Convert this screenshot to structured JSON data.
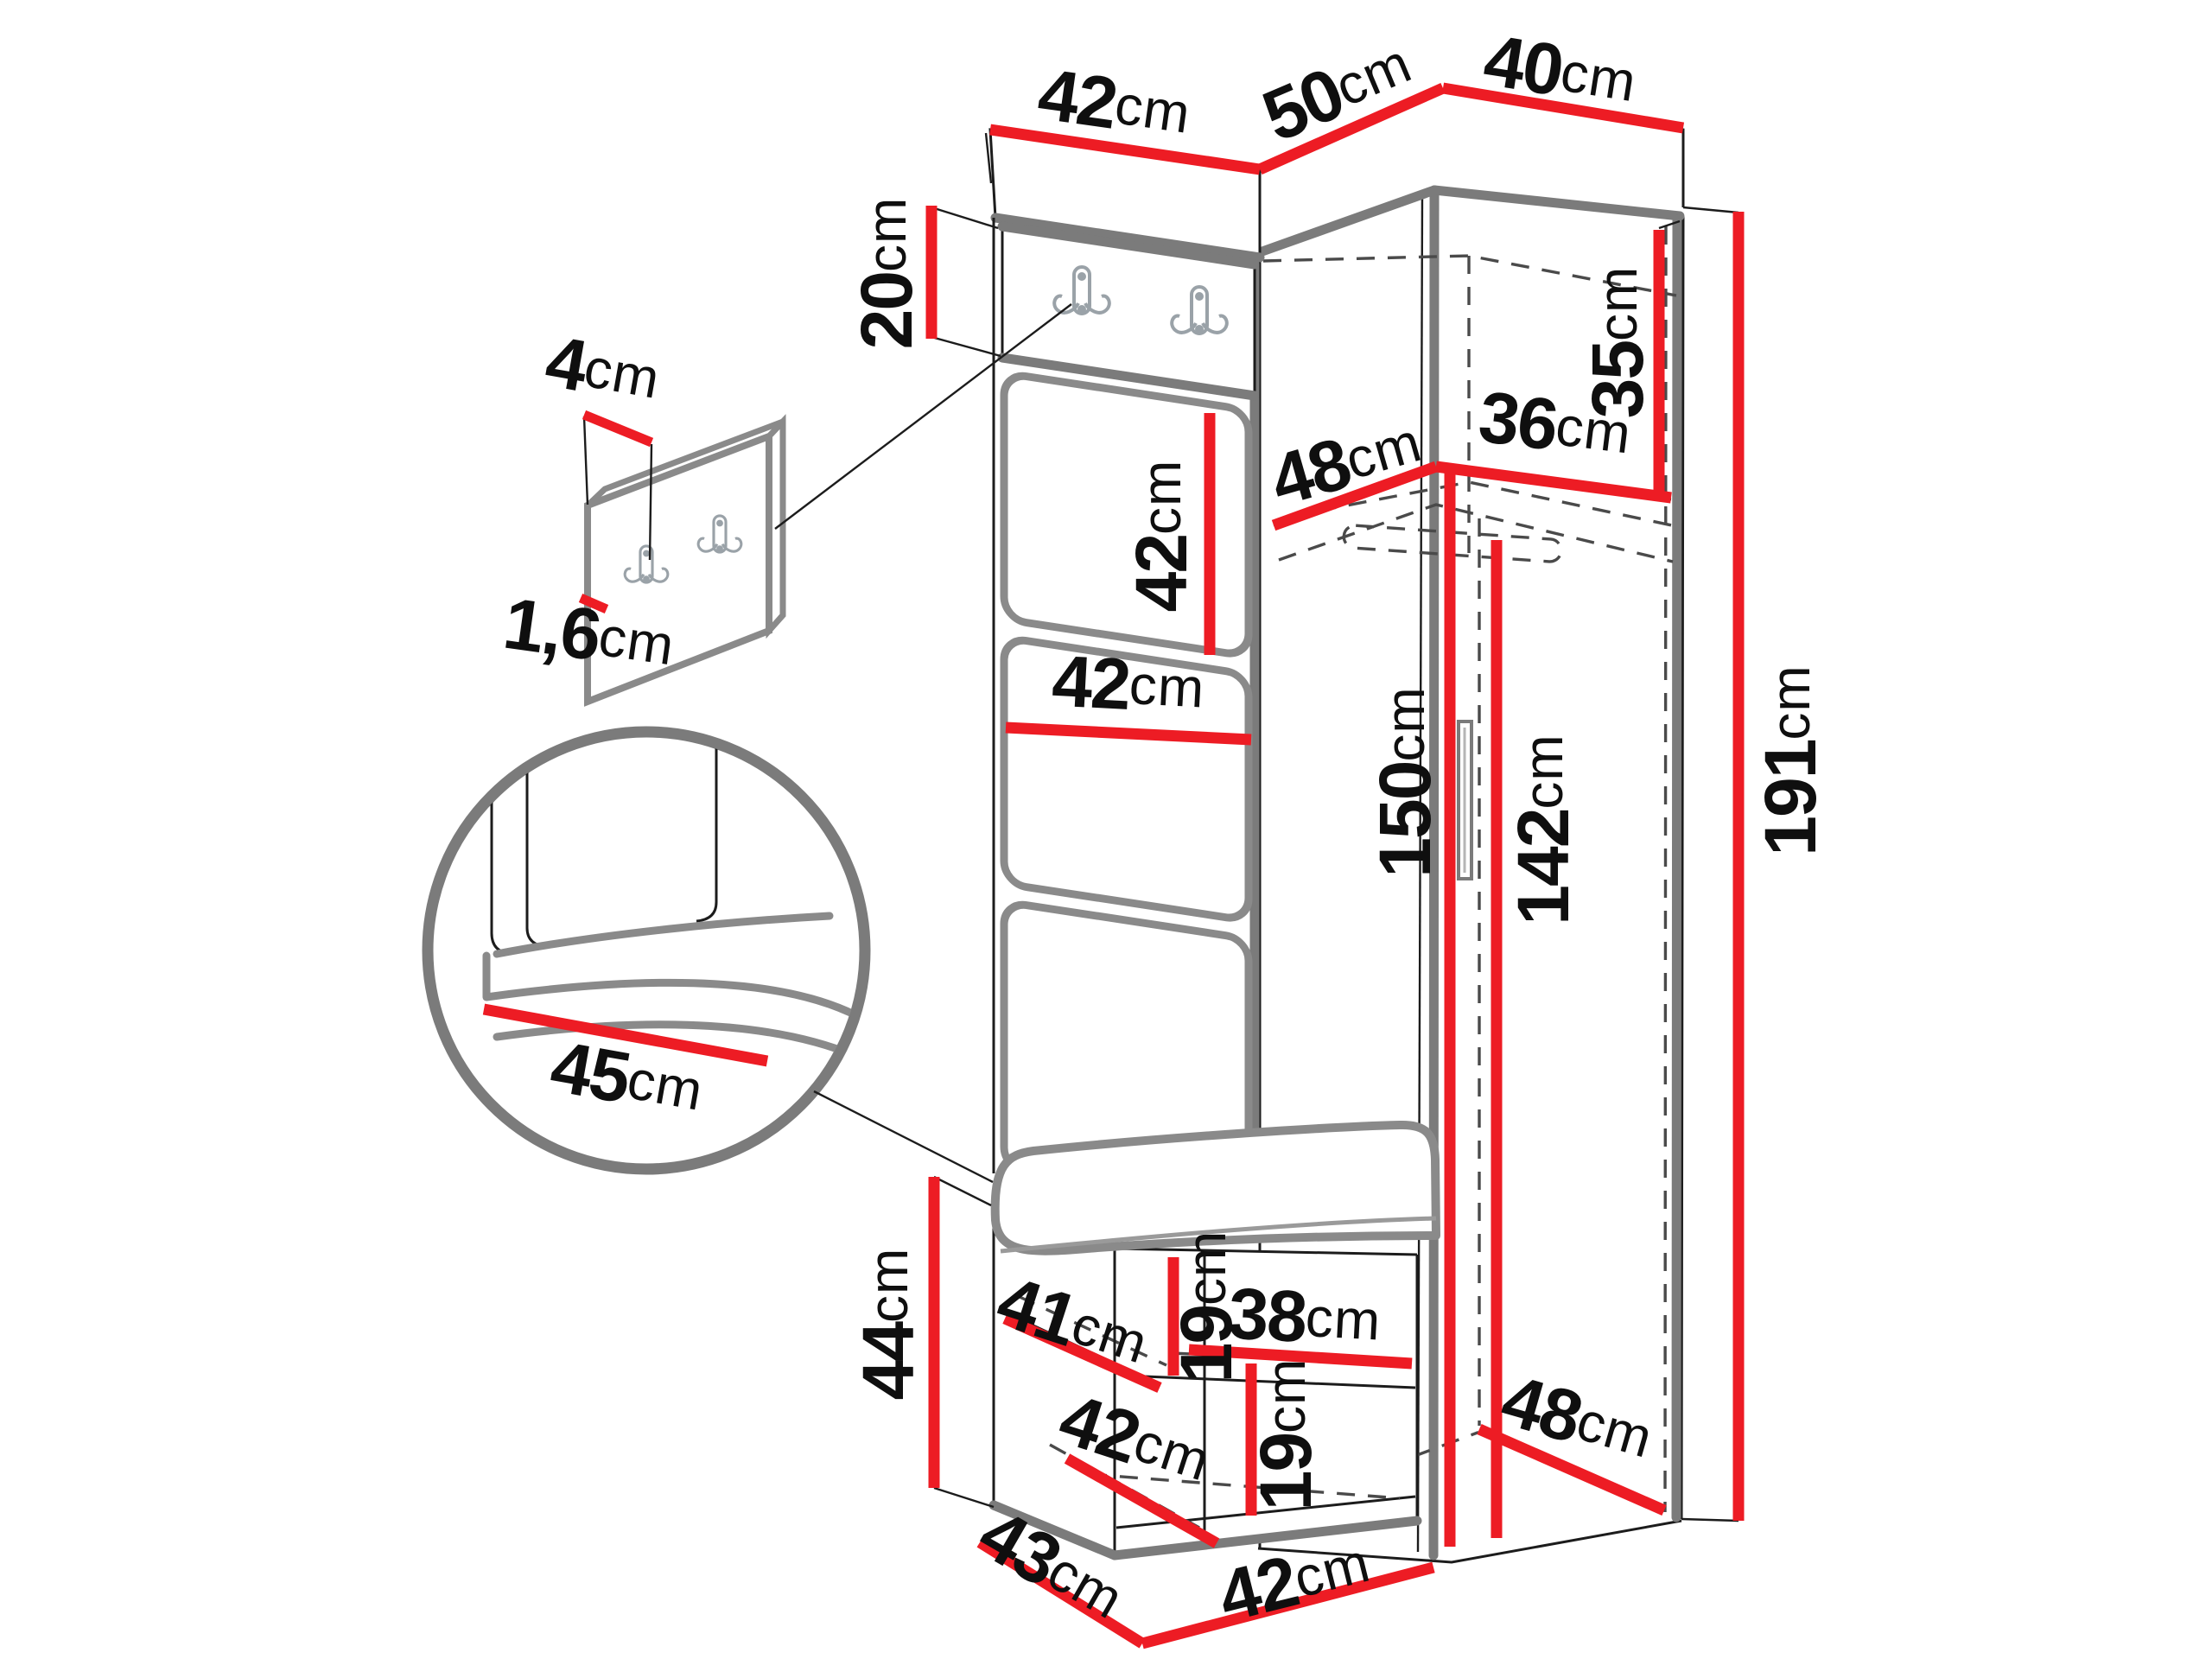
{
  "diagram": {
    "title": "hallway-furniture-set-dimension-diagram",
    "units": "cm",
    "colors": {
      "dimension_line": "#ed1c24",
      "outline": "#1c1c1c",
      "edge": "#7b7b7b"
    },
    "dimensions": {
      "panel_top_width": {
        "value": "42",
        "unit": "cm"
      },
      "wardrobe_side_depth": {
        "value": "50",
        "unit": "cm"
      },
      "wardrobe_front_width": {
        "value": "40",
        "unit": "cm"
      },
      "hook_panel_height": {
        "value": "20",
        "unit": "cm"
      },
      "detail_panel_depth": {
        "value": "4",
        "unit": "cm"
      },
      "detail_panel_thickness": {
        "value": "1,6",
        "unit": "cm"
      },
      "upholstered_panel_height": {
        "value": "42",
        "unit": "cm"
      },
      "upholstered_panel_width": {
        "value": "42",
        "unit": "cm"
      },
      "seat_depth_detail": {
        "value": "45",
        "unit": "cm"
      },
      "top_compartment_height": {
        "value": "35",
        "unit": "cm"
      },
      "top_shelf_width": {
        "value": "36",
        "unit": "cm"
      },
      "top_shelf_depth": {
        "value": "48",
        "unit": "cm"
      },
      "interior_height": {
        "value": "150",
        "unit": "cm"
      },
      "door_height": {
        "value": "142",
        "unit": "cm"
      },
      "total_height": {
        "value": "191",
        "unit": "cm"
      },
      "bench_height": {
        "value": "44",
        "unit": "cm"
      },
      "bench_shelf_depth": {
        "value": "41",
        "unit": "cm"
      },
      "bench_upper_compartment_height": {
        "value": "19",
        "unit": "cm"
      },
      "bench_shelf_width": {
        "value": "38",
        "unit": "cm"
      },
      "bench_lower_depth": {
        "value": "42",
        "unit": "cm"
      },
      "bench_lower_compartment_height": {
        "value": "19",
        "unit": "cm"
      },
      "bench_base_depth": {
        "value": "43",
        "unit": "cm"
      },
      "bench_base_width": {
        "value": "42",
        "unit": "cm"
      },
      "wardrobe_floor_depth": {
        "value": "48",
        "unit": "cm"
      }
    }
  }
}
